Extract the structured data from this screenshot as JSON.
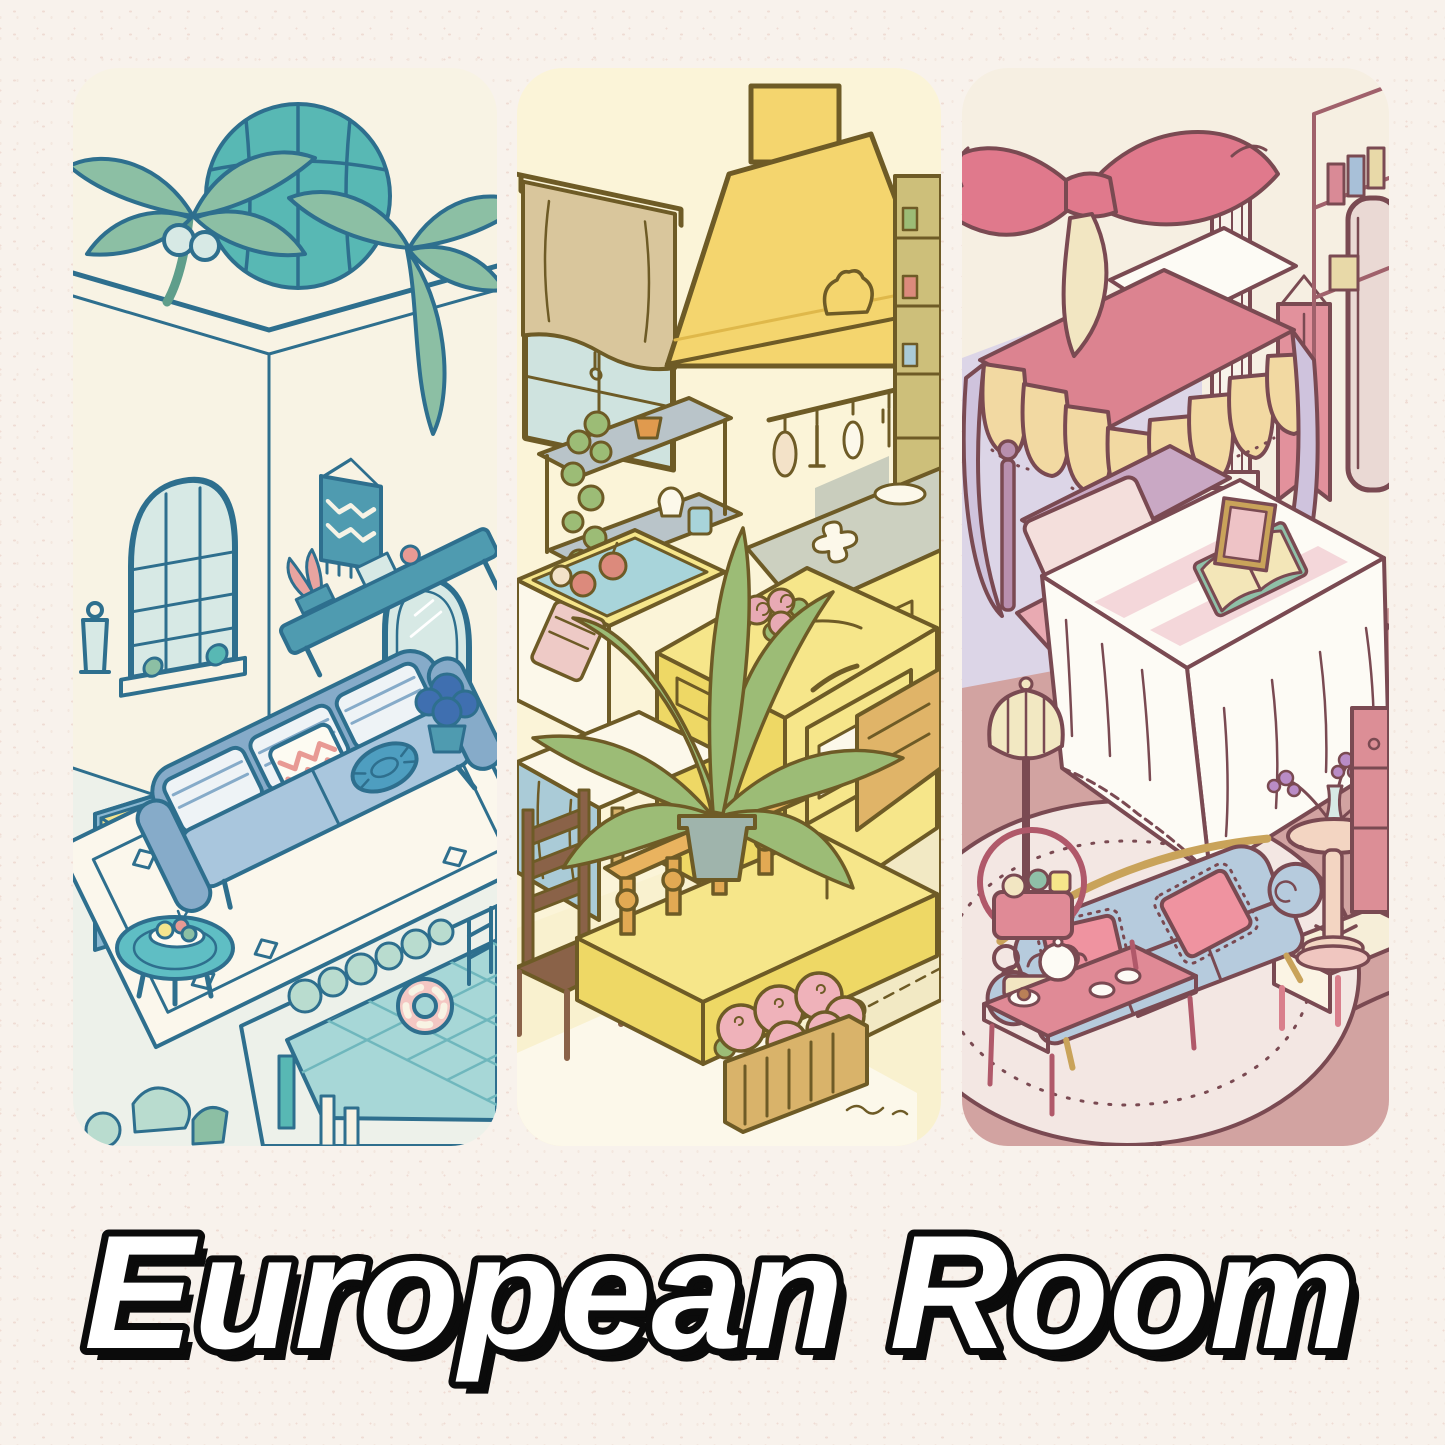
{
  "title": {
    "text": "European Room"
  },
  "panels": [
    {
      "name": "blue-mediterranean-pool-lounge"
    },
    {
      "name": "yellow-country-kitchen"
    },
    {
      "name": "pink-vintage-bedroom"
    }
  ],
  "palette": {
    "paper_bg": "#f8f2ec",
    "speckle1": "#efdcd4",
    "speckle2": "#f3e7df",
    "title_fill": "#ffffff",
    "title_outline": "#0b0b0b",
    "p1_bg": "#f8f3e4",
    "p1_outline": "#2e6f8e",
    "p1_leaf": "#8cbfa4",
    "p1_leaf_dark": "#5f9e8b",
    "p1_dome": "#58b8b4",
    "p1_glass": "#d7e9e5",
    "p1_teal": "#4f9bb0",
    "p1_sofa": "#a9c6dd",
    "p1_sofa_dark": "#86abc9",
    "p1_cushion": "#eef3f6",
    "p1_zigzag": "#e89a94",
    "p1_pouf": "#4e9ec0",
    "p1_table": "#5fbec4",
    "p1_rug": "#fbf7ec",
    "p1_floor": "#edf1ea",
    "p1_pool": "#a7d7d7",
    "p1_pool_line": "#6fb7bd",
    "p1_ring": "#f4c7c3",
    "p1_dresser": "#8bb9d2",
    "p1_drawer": "#a9cde0",
    "p1_yellow": "#f4e58e",
    "p1_hedge": "#b9dccf",
    "p1_pink": "#e8a4a0",
    "p1_pot": "#3f6fb0",
    "p2_bg": "#fbf4d8",
    "p2_outline": "#6e5b26",
    "p2_hood": "#f4d56e",
    "p2_hood_dark": "#dfb84a",
    "p2_curtain": "#d9c69c",
    "p2_glass": "#cfe3df",
    "p2_counter": "#ccd0c0",
    "p2_cabinet": "#f6e68a",
    "p2_cabinet_dark": "#eed865",
    "p2_leaf": "#9cbc76",
    "p2_leaf_dark": "#779e52",
    "p2_water": "#a8d4da",
    "p2_apple": "#dc8a7c",
    "p2_towel": "#eecac6",
    "p2_rose": "#e8aab4",
    "p2_baluster": "#e2a953",
    "p2_rail": "#e9b35f",
    "p2_wood": "#d9b36a",
    "p2_hydrangea": "#efb2ba",
    "p2_chair": "#8a6248",
    "p2_cloth": "#aacbd7",
    "p2_rug": "#f2e9c4",
    "p2_floor": "#f9f1cf",
    "p2_white": "#fcf8ea",
    "p2_gray_wall": "#c9cdbd",
    "p2_soil": "#8a6242",
    "p2_pot": "#9fb4ac",
    "p2_shelf": "#b9c4c9",
    "p3_bg": "#f6efe2",
    "p3_outline": "#7a4a52",
    "p3_floor": "#d2a3a1",
    "p3_rug": "#f3e7e3",
    "p3_bow": "#e0798c",
    "p3_canopy": "#dc8390",
    "p3_valance": "#f2d9a2",
    "p3_curtain": "#cfc3dd",
    "p3_lilac": "#dcd5e7",
    "p3_headboard": "#c9a8c4",
    "p3_pillow1": "#f4dfdc",
    "p3_pillow2": "#eec3c6",
    "p3_white": "#fdfbf5",
    "p3_stripe": "#f4d7da",
    "p3_book_green": "#8fc0a8",
    "p3_book_page": "#f3e6b8",
    "p3_lamp": "#f2e8c2",
    "p3_sofa": "#b6cbdd",
    "p3_cushion": "#ef93a0",
    "p3_table": "#e08a96",
    "p3_side": "#f3d5c2",
    "p3_bench": "#f6eed8",
    "p3_bench_leg": "#d97f8c",
    "p3_banner": "#e2919c",
    "p3_column": "#f8f3ea",
    "p3_gold": "#c9a35a",
    "p3_flower": "#b98cc6",
    "p3_bed_base": "#e9aab2",
    "p3_chest": "#dc8e96"
  }
}
